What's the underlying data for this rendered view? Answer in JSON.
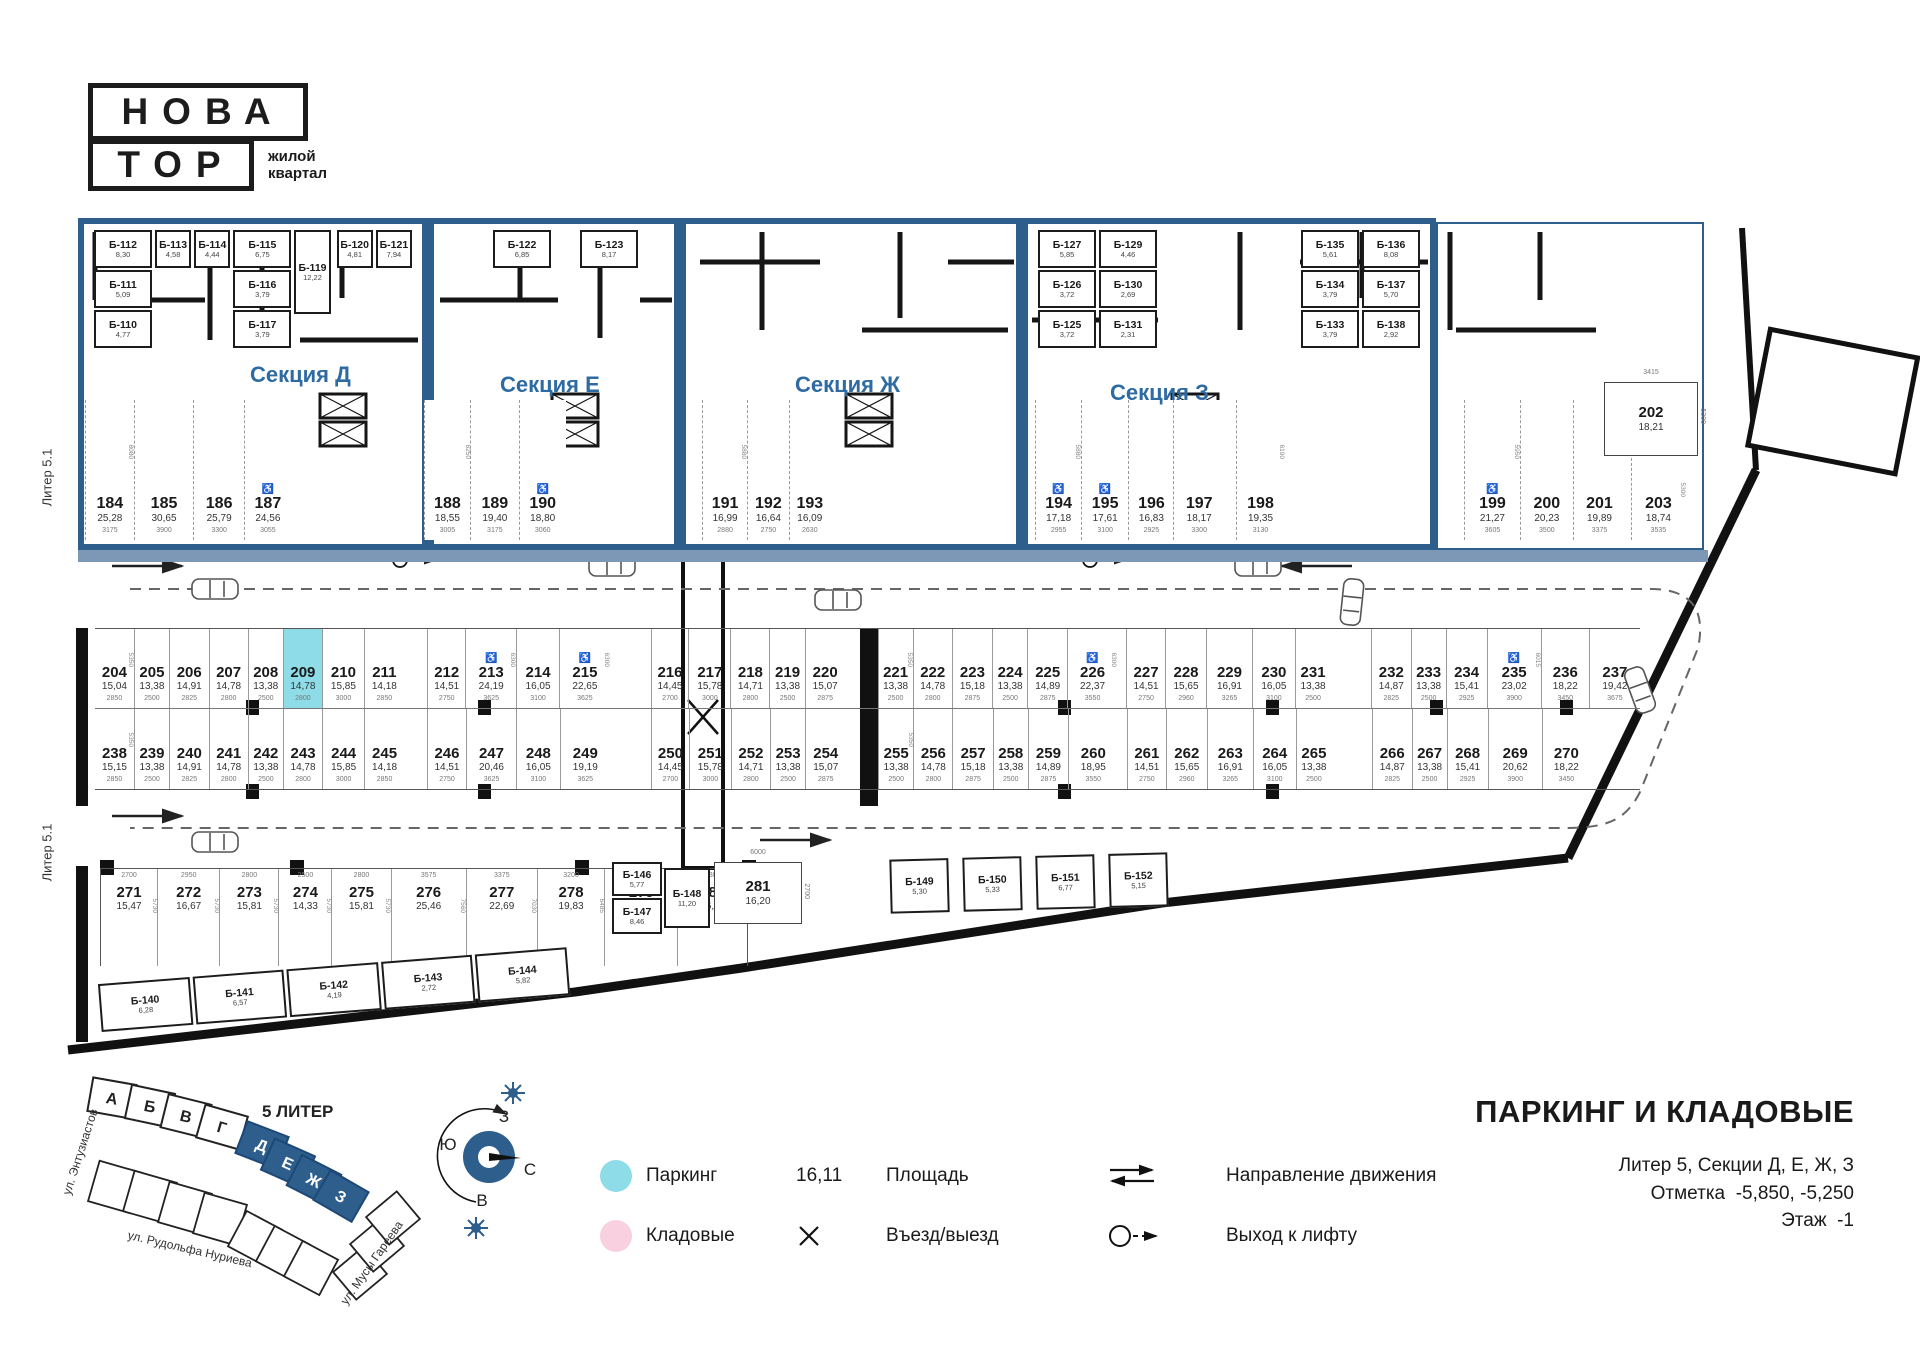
{
  "logo": {
    "line1": "НОВА",
    "line2": "ТОР",
    "tagline1": "жилой",
    "tagline2": "квартал"
  },
  "colors": {
    "accent_blue": "#2d5e8c",
    "band_blue": "#7c98b6",
    "section_label_blue": "#2f6ba3",
    "parking_cyan": "#8edce8",
    "storage_pink": "#f8d0e0"
  },
  "plan": {
    "liter_label_top": "Литер 5.1",
    "liter_label_bottom": "Литер 5.1",
    "sections": [
      {
        "name": "Секция Д",
        "storages": [
          {
            "stack": [
              {
                "id": "Б-112",
                "area": "8,30"
              },
              {
                "id": "Б-111",
                "area": "5,09"
              },
              {
                "id": "Б-110",
                "area": "4,77"
              }
            ]
          },
          {
            "id": "Б-113",
            "area": "4,58"
          },
          {
            "id": "Б-114",
            "area": "4,44"
          },
          {
            "stack": [
              {
                "id": "Б-115",
                "area": "6,75"
              },
              {
                "id": "Б-116",
                "area": "3,79"
              },
              {
                "id": "Б-117",
                "area": "3,79"
              }
            ]
          },
          {
            "id": "Б-119",
            "area": "12,22",
            "tall": true
          },
          {
            "gap": 1
          },
          {
            "id": "Б-120",
            "area": "4,81"
          },
          {
            "id": "Б-121",
            "area": "7,94"
          }
        ]
      },
      {
        "name": "Секция Е",
        "storages": [
          {
            "gap": 2
          },
          {
            "id": "Б-122",
            "area": "6,85"
          },
          {
            "gap": 1
          },
          {
            "id": "Б-123",
            "area": "8,17"
          },
          {
            "gap": 1
          }
        ]
      },
      {
        "name": "Секция Ж",
        "storages": []
      },
      {
        "name": "Секция З",
        "storages": [
          {
            "stack": [
              {
                "id": "Б-127",
                "area": "5,85"
              },
              {
                "id": "Б-126",
                "area": "3,72"
              },
              {
                "id": "Б-125",
                "area": "3,72"
              }
            ]
          },
          {
            "stack": [
              {
                "id": "Б-129",
                "area": "4,46"
              },
              {
                "id": "Б-130",
                "area": "2,69"
              },
              {
                "id": "Б-131",
                "area": "2,31"
              }
            ]
          },
          {
            "gap": 4
          },
          {
            "stack": [
              {
                "id": "Б-135",
                "area": "5,61"
              },
              {
                "id": "Б-134",
                "area": "3,79"
              },
              {
                "id": "Б-133",
                "area": "3,79"
              }
            ]
          },
          {
            "stack": [
              {
                "id": "Б-136",
                "area": "8,08"
              },
              {
                "id": "Б-137",
                "area": "5,70"
              },
              {
                "id": "Б-138",
                "area": "2,92"
              }
            ]
          }
        ]
      }
    ],
    "row_top": [
      {
        "n": "184",
        "a": "25,28",
        "d": "3175",
        "dp": "8080"
      },
      {
        "n": "185",
        "a": "30,65",
        "d": "3900"
      },
      {
        "n": "186",
        "a": "25,79",
        "d": "3300"
      },
      {
        "n": "187",
        "a": "24,56",
        "d": "3055",
        "hc": true
      },
      {
        "sp": 8850
      },
      {
        "n": "188",
        "a": "18,55",
        "d": "3005",
        "dp": "6250"
      },
      {
        "n": "189",
        "a": "19,40",
        "d": "3175"
      },
      {
        "n": "190",
        "a": "18,80",
        "d": "3060",
        "hc": true
      },
      {
        "sp": 9100
      },
      {
        "n": "191",
        "a": "16,99",
        "d": "2880",
        "dp": "5880"
      },
      {
        "n": "192",
        "a": "16,64",
        "d": "2750"
      },
      {
        "n": "193",
        "a": "16,09",
        "d": "2630"
      },
      {
        "sp": 13700
      },
      {
        "n": "194",
        "a": "17,18",
        "d": "2955",
        "hc": true,
        "dp": "5880"
      },
      {
        "n": "195",
        "a": "17,61",
        "d": "3100",
        "hc": true
      },
      {
        "n": "196",
        "a": "16,83",
        "d": "2925"
      },
      {
        "n": "197",
        "a": "18,17",
        "d": "3300"
      },
      {
        "sp": 800
      },
      {
        "n": "198",
        "a": "19,35",
        "d": "3130",
        "dp": "6190"
      },
      {
        "sp": 12000
      },
      {
        "n": "199",
        "a": "21,27",
        "d": "3605",
        "hc": true,
        "dp": "5950"
      },
      {
        "n": "200",
        "a": "20,23",
        "d": "3500"
      },
      {
        "n": "201",
        "a": "19,89",
        "d": "3375"
      },
      {
        "sp": 400
      },
      {
        "n": "203",
        "a": "18,74",
        "d": "3535",
        "dp": "5300",
        "mt": 58
      }
    ],
    "row_a": [
      {
        "n": "204",
        "a": "15,04",
        "d": "2850",
        "dp": "5350"
      },
      {
        "n": "205",
        "a": "13,38",
        "d": "2500"
      },
      {
        "n": "206",
        "a": "14,91",
        "d": "2825"
      },
      {
        "n": "207",
        "a": "14,78",
        "d": "2800"
      },
      {
        "n": "208",
        "a": "13,38",
        "d": "2500"
      },
      {
        "n": "209",
        "a": "14,78",
        "d": "2800",
        "hl": true
      },
      {
        "n": "210",
        "a": "15,85",
        "d": "3000"
      },
      {
        "n": "211",
        "a": "14,18",
        "d": "2850"
      },
      {
        "sp": 1700
      },
      {
        "n": "212",
        "a": "14,51",
        "d": "2750"
      },
      {
        "n": "213",
        "a": "24,19",
        "d": "3625",
        "hc": true,
        "dp": "6300"
      },
      {
        "n": "214",
        "a": "16,05",
        "d": "3100"
      },
      {
        "n": "215",
        "a": "22,65",
        "d": "3625",
        "hc": true,
        "dp": "6300"
      },
      {
        "sp": 3000
      },
      {
        "n": "216",
        "a": "14,45",
        "d": "2700"
      },
      {
        "n": "217",
        "a": "15,78",
        "d": "3000"
      },
      {
        "n": "218",
        "a": "14,71",
        "d": "2800"
      },
      {
        "n": "219",
        "a": "13,38",
        "d": "2500"
      },
      {
        "n": "220",
        "a": "15,07",
        "d": "2875"
      },
      {
        "sp": 2400
      },
      {
        "n": "221",
        "a": "13,38",
        "d": "2500",
        "dp": "5350"
      },
      {
        "n": "222",
        "a": "14,78",
        "d": "2800"
      },
      {
        "n": "223",
        "a": "15,18",
        "d": "2875"
      },
      {
        "n": "224",
        "a": "13,38",
        "d": "2500"
      },
      {
        "n": "225",
        "a": "14,89",
        "d": "2875"
      },
      {
        "n": "226",
        "a": "22,37",
        "d": "3550",
        "hc": true,
        "dp": "6300"
      },
      {
        "sp": 700
      },
      {
        "n": "227",
        "a": "14,51",
        "d": "2750"
      },
      {
        "n": "228",
        "a": "15,65",
        "d": "2960"
      },
      {
        "n": "229",
        "a": "16,91",
        "d": "3265"
      },
      {
        "n": "230",
        "a": "16,05",
        "d": "3100"
      },
      {
        "n": "231",
        "a": "13,38",
        "d": "2500"
      },
      {
        "sp": 3000
      },
      {
        "n": "232",
        "a": "14,87",
        "d": "2825"
      },
      {
        "n": "233",
        "a": "13,38",
        "d": "2500"
      },
      {
        "n": "234",
        "a": "15,41",
        "d": "2925"
      },
      {
        "n": "235",
        "a": "23,02",
        "d": "3900",
        "hc": true,
        "dp": "6015"
      },
      {
        "n": "236",
        "a": "18,22",
        "d": "3450"
      },
      {
        "n": "237",
        "a": "19,42",
        "d": "3675"
      }
    ],
    "row_b": [
      {
        "n": "238",
        "a": "15,15",
        "d": "2850",
        "dp": "5350"
      },
      {
        "n": "239",
        "a": "13,38",
        "d": "2500"
      },
      {
        "n": "240",
        "a": "14,91",
        "d": "2825"
      },
      {
        "n": "241",
        "a": "14,78",
        "d": "2800"
      },
      {
        "n": "242",
        "a": "13,38",
        "d": "2500"
      },
      {
        "n": "243",
        "a": "14,78",
        "d": "2800"
      },
      {
        "n": "244",
        "a": "15,85",
        "d": "3000"
      },
      {
        "n": "245",
        "a": "14,18",
        "d": "2850"
      },
      {
        "sp": 1700
      },
      {
        "n": "246",
        "a": "14,51",
        "d": "2750"
      },
      {
        "n": "247",
        "a": "20,46",
        "d": "3625"
      },
      {
        "n": "248",
        "a": "16,05",
        "d": "3100"
      },
      {
        "n": "249",
        "a": "19,19",
        "d": "3625"
      },
      {
        "sp": 3000
      },
      {
        "n": "250",
        "a": "14,45",
        "d": "2700"
      },
      {
        "n": "251",
        "a": "15,78",
        "d": "3000"
      },
      {
        "n": "252",
        "a": "14,71",
        "d": "2800"
      },
      {
        "n": "253",
        "a": "13,38",
        "d": "2500"
      },
      {
        "n": "254",
        "a": "15,07",
        "d": "2875"
      },
      {
        "sp": 2400
      },
      {
        "n": "255",
        "a": "13,38",
        "d": "2500",
        "dp": "5350"
      },
      {
        "n": "256",
        "a": "14,78",
        "d": "2800"
      },
      {
        "n": "257",
        "a": "15,18",
        "d": "2875"
      },
      {
        "n": "258",
        "a": "13,38",
        "d": "2500"
      },
      {
        "n": "259",
        "a": "14,89",
        "d": "2875"
      },
      {
        "n": "260",
        "a": "18,95",
        "d": "3550"
      },
      {
        "sp": 700
      },
      {
        "n": "261",
        "a": "14,51",
        "d": "2750"
      },
      {
        "n": "262",
        "a": "15,65",
        "d": "2960"
      },
      {
        "n": "263",
        "a": "16,91",
        "d": "3265"
      },
      {
        "n": "264",
        "a": "16,05",
        "d": "3100"
      },
      {
        "n": "265",
        "a": "13,38",
        "d": "2500"
      },
      {
        "sp": 3000
      },
      {
        "n": "266",
        "a": "14,87",
        "d": "2825"
      },
      {
        "n": "267",
        "a": "13,38",
        "d": "2500"
      },
      {
        "n": "268",
        "a": "15,41",
        "d": "2925"
      },
      {
        "n": "269",
        "a": "20,62",
        "d": "3900"
      },
      {
        "n": "270",
        "a": "18,22",
        "d": "3450"
      },
      {
        "sp": 3675
      }
    ],
    "row_c": [
      {
        "n": "271",
        "a": "15,47",
        "d": "2700",
        "dp": "5730"
      },
      {
        "n": "272",
        "a": "16,67",
        "d": "2950",
        "dp": "5730"
      },
      {
        "n": "273",
        "a": "15,81",
        "d": "2800",
        "dp": "5730"
      },
      {
        "n": "274",
        "a": "14,33",
        "d": "2500",
        "dp": "5730"
      },
      {
        "n": "275",
        "a": "15,81",
        "d": "2800",
        "dp": "5730"
      },
      {
        "n": "276",
        "a": "25,46",
        "d": "3575",
        "dp": "7560"
      },
      {
        "n": "277",
        "a": "22,69",
        "d": "3375",
        "dp": "7030"
      },
      {
        "n": "278",
        "a": "19,83",
        "d": "3200",
        "dp": "6485"
      },
      {
        "n": "279",
        "a": "19,48",
        "d": "3475",
        "dp": "5885"
      },
      {
        "n": "280",
        "a": "16,67",
        "d": "3300",
        "dp": "5430"
      }
    ],
    "stall_202": {
      "n": "202",
      "a": "18,21",
      "dim_top": "3415",
      "dp": "5300"
    },
    "stall_281": {
      "n": "281",
      "a": "16,20",
      "dim_w": "6000",
      "dim_h": "2700"
    },
    "storage_bottom_left": [
      {
        "id": "Б-140",
        "area": "6,28"
      },
      {
        "id": "Б-141",
        "area": "6,57"
      },
      {
        "id": "Б-142",
        "area": "4,19"
      },
      {
        "id": "Б-143",
        "area": "2,72"
      },
      {
        "id": "Б-144",
        "area": "5,82"
      }
    ],
    "storage_mid": [
      {
        "id": "Б-146",
        "area": "5,77"
      },
      {
        "id": "Б-147",
        "area": "8,46"
      },
      {
        "id": "Б-148",
        "area": "11,20"
      }
    ],
    "storage_bottom_right": [
      {
        "id": "Б-149",
        "area": "5,30"
      },
      {
        "id": "Б-150",
        "area": "5,33"
      },
      {
        "id": "Б-151",
        "area": "6,77"
      },
      {
        "id": "Б-152",
        "area": "5,15"
      }
    ]
  },
  "legend": {
    "parking_label": "Паркинг",
    "storage_label": "Кладовые",
    "area_sample": "16,11",
    "area_label": "Площадь",
    "entry_label": "Въезд/выезд",
    "direction_label": "Направление движения",
    "lift_label": "Выход к лифту"
  },
  "site_plan": {
    "liter_title": "5 ЛИТЕР",
    "buildings_other": [
      "А",
      "Б",
      "В",
      "Г"
    ],
    "buildings_current": [
      "Д",
      "Е",
      "Ж",
      "З"
    ],
    "street_1": "ул. Энтузиастов",
    "street_2": "ул. Рудольфа Нуриева",
    "street_3": "ул. Мусы Гареева"
  },
  "compass": {
    "north": "С",
    "south": "Ю",
    "west": "З",
    "east": "В"
  },
  "title_block": {
    "title": "ПАРКИНГ И КЛАДОВЫЕ",
    "subtitle": "Литер 5, Секции Д, Е, Ж, З",
    "mark_label": "Отметка",
    "mark_value": "-5,850, -5,250",
    "floor_label": "Этаж",
    "floor_value": "-1"
  }
}
